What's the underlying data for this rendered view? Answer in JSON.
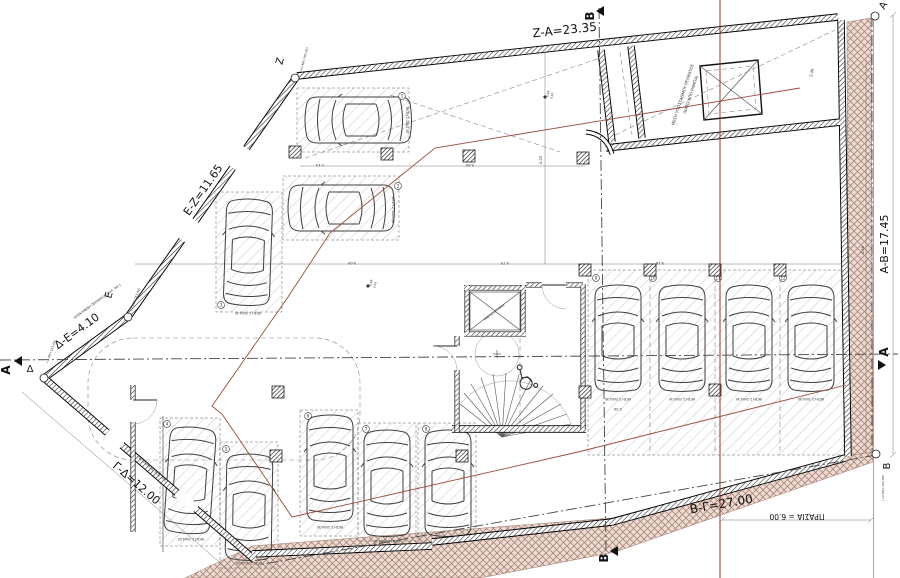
{
  "labels": {
    "za": "Z-A=23.35",
    "ez": "E-Z=11.65",
    "de": "Δ-E=4.10",
    "gd": "Γ-Δ=12.00",
    "bg": "B-Γ=27.00",
    "ab": "A-B=17.45",
    "prasia": "ΠΡΑΣΙΑ = 6.00"
  },
  "vertices": {
    "z": {
      "l": "Z",
      "e": "(+0.48/+165.45)"
    },
    "a": {
      "l": "A"
    },
    "b": {
      "l": "B",
      "e": "(+0.00/+164.98)"
    },
    "d": {
      "l": "Δ",
      "e": "(-1.49/+163.48)"
    },
    "e": {
      "l": "E",
      "e": "(-1.49/+163.48)"
    }
  },
  "sections": {
    "a": "A",
    "b": "B"
  },
  "ramp": {
    "line1": "ΘΕΣΗ ΥΠΟΣΤΑΘΜΟΥ ΡΕΥΜΑΤΟΣ",
    "line2": "(ΚΑΤΩ ΑΠΟ ΡΑΜΠΑ)"
  },
  "core": {
    "elevator": "ΑΝΕΛΚΥΣΤΗΡΑΣ"
  },
  "stalls": {
    "label": "ΘΕΣΗ 2.30Χ4.50",
    "numbers": [
      "1",
      "2",
      "3",
      "4",
      "5",
      "6",
      "7",
      "8",
      "9",
      "10",
      "11",
      "12"
    ]
  },
  "annotations": {
    "fence": "ΑΣΦΑΛΜΕΝΗ ΠΕΡΙΦΡΑΞΗ ΚΟΛ. ΑΘ.1",
    "old": "ΠΑΛΑΙΩΜΕΝΟ ΚΟΛ. ΑΘ.1"
  },
  "dims": {
    "v1": "5.75",
    "v2": "4.25",
    "v3": "5.18",
    "v4": "2.30",
    "v5": "4.50",
    "v6": "5.00",
    "v7": "2.40",
    "v8": "1.15",
    "v9": "3.40",
    "s1": "0.48",
    "s2": "0.45"
  },
  "colors": {
    "overlay_red": "#9c4a3a",
    "boundary_green": "#a8b83a",
    "earth_line": "#ab8474",
    "earth_bg": "#ecdcd4"
  }
}
